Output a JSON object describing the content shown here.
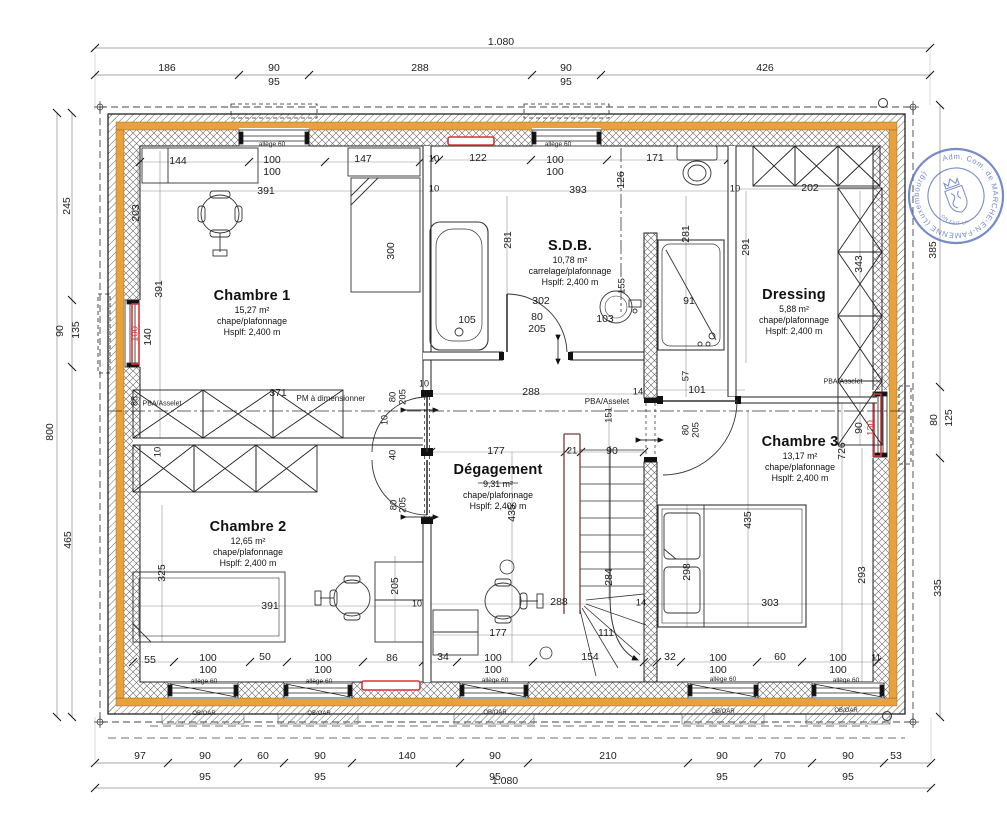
{
  "colors": {
    "wall_orange": "#E8A13C",
    "highlight_red": "#D6353C",
    "stamp_blue": "#5872BE",
    "rail_red": "#7a3b3b",
    "line": "#222222"
  },
  "stamp": {
    "text": "Adm. Com. de MARCHE-EN-FAMENNE (Luxembourg)",
    "inner": "ON FAIT LA"
  },
  "rooms": [
    {
      "name": "Chambre 1",
      "area": "15,27 m²",
      "finish": "chape/plafonnage",
      "height": "Hsplf: 2,400 m",
      "x": 252,
      "y": 289
    },
    {
      "name": "S.D.B.",
      "area": "10,78 m²",
      "finish": "carrelage/plafonnage",
      "height": "Hsplf: 2,400 m",
      "x": 570,
      "y": 239
    },
    {
      "name": "Dressing",
      "area": "5,88 m²",
      "finish": "chape/plafonnage",
      "height": "Hsplf: 2,400 m",
      "x": 794,
      "y": 288
    },
    {
      "name": "Dégagement",
      "area": "9,31 m²",
      "finish": "chape/plafonnage",
      "height": "Hsplf: 2,400 m",
      "x": 498,
      "y": 463
    },
    {
      "name": "Chambre 2",
      "area": "12,65 m²",
      "finish": "chape/plafonnage",
      "height": "Hsplf: 2,400 m",
      "x": 248,
      "y": 520
    },
    {
      "name": "Chambre 3",
      "area": "13,17 m²",
      "finish": "chape/plafonnage",
      "height": "Hsplf: 2,400 m",
      "x": 800,
      "y": 435
    }
  ],
  "labels": [
    {
      "t": "1.080",
      "x": 501,
      "y": 42
    },
    {
      "t": "186",
      "x": 167,
      "y": 68
    },
    {
      "t": "90",
      "x": 274,
      "y": 68
    },
    {
      "t": "95",
      "x": 274,
      "y": 82
    },
    {
      "t": "288",
      "x": 420,
      "y": 68
    },
    {
      "t": "90",
      "x": 566,
      "y": 68
    },
    {
      "t": "95",
      "x": 566,
      "y": 82
    },
    {
      "t": "426",
      "x": 765,
      "y": 68
    },
    {
      "t": "97",
      "x": 140,
      "y": 756
    },
    {
      "t": "90",
      "x": 205,
      "y": 756
    },
    {
      "t": "95",
      "x": 205,
      "y": 777
    },
    {
      "t": "60",
      "x": 263,
      "y": 756
    },
    {
      "t": "90",
      "x": 320,
      "y": 756
    },
    {
      "t": "95",
      "x": 320,
      "y": 777
    },
    {
      "t": "140",
      "x": 407,
      "y": 756
    },
    {
      "t": "90",
      "x": 495,
      "y": 756
    },
    {
      "t": "95",
      "x": 495,
      "y": 777
    },
    {
      "t": "210",
      "x": 608,
      "y": 756
    },
    {
      "t": "90",
      "x": 722,
      "y": 756
    },
    {
      "t": "95",
      "x": 722,
      "y": 777
    },
    {
      "t": "70",
      "x": 780,
      "y": 756
    },
    {
      "t": "90",
      "x": 848,
      "y": 756
    },
    {
      "t": "95",
      "x": 848,
      "y": 777
    },
    {
      "t": "53",
      "x": 896,
      "y": 756
    },
    {
      "t": "1.080",
      "x": 505,
      "y": 781
    },
    {
      "t": "245",
      "x": 67,
      "y": 206,
      "r": -90
    },
    {
      "t": "90",
      "x": 60,
      "y": 331,
      "r": -90
    },
    {
      "t": "135",
      "x": 76,
      "y": 330,
      "r": -90
    },
    {
      "t": "800",
      "x": 50,
      "y": 432,
      "r": -90
    },
    {
      "t": "465",
      "x": 68,
      "y": 540,
      "r": -90
    },
    {
      "t": "385",
      "x": 933,
      "y": 250,
      "r": -90
    },
    {
      "t": "80",
      "x": 934,
      "y": 420,
      "r": -90
    },
    {
      "t": "125",
      "x": 949,
      "y": 418,
      "r": -90
    },
    {
      "t": "335",
      "x": 938,
      "y": 588,
      "r": -90
    },
    {
      "t": "144",
      "x": 178,
      "y": 161
    },
    {
      "t": "100",
      "x": 272,
      "y": 160
    },
    {
      "t": "100",
      "x": 272,
      "y": 172
    },
    {
      "t": "147",
      "x": 363,
      "y": 159
    },
    {
      "t": "10",
      "x": 434,
      "y": 159,
      "s": 9.5
    },
    {
      "t": "122",
      "x": 478,
      "y": 158
    },
    {
      "t": "100",
      "x": 555,
      "y": 160
    },
    {
      "t": "100",
      "x": 555,
      "y": 172
    },
    {
      "t": "171",
      "x": 655,
      "y": 158
    },
    {
      "t": "10",
      "x": 735,
      "y": 189,
      "s": 9.5
    },
    {
      "t": "202",
      "x": 810,
      "y": 188
    },
    {
      "t": "391",
      "x": 266,
      "y": 191
    },
    {
      "t": "10",
      "x": 434,
      "y": 189,
      "s": 9.5
    },
    {
      "t": "393",
      "x": 578,
      "y": 190
    },
    {
      "t": "126",
      "x": 621,
      "y": 180,
      "r": -90
    },
    {
      "t": "203",
      "x": 136,
      "y": 213,
      "r": -90
    },
    {
      "t": "391",
      "x": 159,
      "y": 289,
      "r": -90
    },
    {
      "t": "100",
      "x": 135,
      "y": 334,
      "r": -90,
      "c": "red",
      "s": 9.5
    },
    {
      "t": "140",
      "x": 148,
      "y": 337,
      "r": -90
    },
    {
      "t": "300",
      "x": 391,
      "y": 251,
      "r": -90
    },
    {
      "t": "281",
      "x": 508,
      "y": 240,
      "r": -90
    },
    {
      "t": "281",
      "x": 686,
      "y": 234,
      "r": -90
    },
    {
      "t": "291",
      "x": 746,
      "y": 247,
      "r": -90
    },
    {
      "t": "343",
      "x": 859,
      "y": 264,
      "r": -90
    },
    {
      "t": "155",
      "x": 622,
      "y": 286,
      "r": -90,
      "s": 9.5
    },
    {
      "t": "302",
      "x": 541,
      "y": 301
    },
    {
      "t": "105",
      "x": 467,
      "y": 320
    },
    {
      "t": "80",
      "x": 537,
      "y": 317
    },
    {
      "t": "205",
      "x": 537,
      "y": 329
    },
    {
      "t": "103",
      "x": 605,
      "y": 319
    },
    {
      "t": "91",
      "x": 689,
      "y": 301
    },
    {
      "t": "88",
      "x": 135,
      "y": 401,
      "r": -90,
      "s": 9
    },
    {
      "t": "PBA/Asselet",
      "x": 162,
      "y": 404,
      "s": 7
    },
    {
      "t": "371",
      "x": 278,
      "y": 393
    },
    {
      "t": "PM à dimensionner",
      "x": 331,
      "y": 399,
      "s": 8
    },
    {
      "t": "10",
      "x": 158,
      "y": 452,
      "r": -90,
      "s": 9.5
    },
    {
      "t": "80",
      "x": 393,
      "y": 397,
      "r": -90,
      "s": 9.5
    },
    {
      "t": "205",
      "x": 403,
      "y": 397,
      "r": -90,
      "s": 9.5
    },
    {
      "t": "10",
      "x": 424,
      "y": 384,
      "s": 9
    },
    {
      "t": "10",
      "x": 385,
      "y": 420,
      "r": -90,
      "s": 9
    },
    {
      "t": "40",
      "x": 393,
      "y": 455,
      "r": -90,
      "s": 9.5
    },
    {
      "t": "288",
      "x": 531,
      "y": 392
    },
    {
      "t": "PBA/Asselet",
      "x": 607,
      "y": 402,
      "s": 8
    },
    {
      "t": "14",
      "x": 638,
      "y": 392,
      "s": 9.5
    },
    {
      "t": "151",
      "x": 609,
      "y": 415,
      "r": -90,
      "s": 9.5
    },
    {
      "t": "57",
      "x": 686,
      "y": 376,
      "r": -90,
      "s": 9.5
    },
    {
      "t": "101",
      "x": 697,
      "y": 390
    },
    {
      "t": "PBA/Asselet",
      "x": 843,
      "y": 382,
      "s": 7
    },
    {
      "t": "80",
      "x": 686,
      "y": 430,
      "r": -90,
      "s": 9.5
    },
    {
      "t": "205",
      "x": 696,
      "y": 430,
      "r": -90,
      "s": 9.5
    },
    {
      "t": "90",
      "x": 859,
      "y": 428,
      "r": -90
    },
    {
      "t": "130",
      "x": 871,
      "y": 428,
      "r": -90,
      "c": "red",
      "s": 9.5
    },
    {
      "t": "726",
      "x": 842,
      "y": 451,
      "r": -90
    },
    {
      "t": "177",
      "x": 496,
      "y": 451
    },
    {
      "t": "21",
      "x": 572,
      "y": 451,
      "s": 9.5
    },
    {
      "t": "90",
      "x": 612,
      "y": 451
    },
    {
      "t": "435",
      "x": 512,
      "y": 513,
      "r": -90
    },
    {
      "t": "435",
      "x": 748,
      "y": 520,
      "r": -90
    },
    {
      "t": "80",
      "x": 394,
      "y": 505,
      "r": -90,
      "s": 9.5
    },
    {
      "t": "205",
      "x": 403,
      "y": 505,
      "r": -90,
      "s": 9.5
    },
    {
      "t": "205",
      "x": 395,
      "y": 586,
      "r": -90
    },
    {
      "t": "325",
      "x": 162,
      "y": 573,
      "r": -90
    },
    {
      "t": "391",
      "x": 270,
      "y": 606
    },
    {
      "t": "288",
      "x": 559,
      "y": 602
    },
    {
      "t": "14",
      "x": 641,
      "y": 603,
      "s": 9.5
    },
    {
      "t": "303",
      "x": 770,
      "y": 603
    },
    {
      "t": "284",
      "x": 609,
      "y": 577,
      "r": -90
    },
    {
      "t": "298",
      "x": 687,
      "y": 572,
      "r": -90
    },
    {
      "t": "293",
      "x": 862,
      "y": 575,
      "r": -90
    },
    {
      "t": "10",
      "x": 417,
      "y": 604,
      "s": 9
    },
    {
      "t": "177",
      "x": 498,
      "y": 633
    },
    {
      "t": "111",
      "x": 606,
      "y": 633
    },
    {
      "t": "154",
      "x": 590,
      "y": 657
    },
    {
      "t": "34",
      "x": 443,
      "y": 657
    },
    {
      "t": "55",
      "x": 150,
      "y": 660
    },
    {
      "t": "100",
      "x": 208,
      "y": 658
    },
    {
      "t": "100",
      "x": 208,
      "y": 670
    },
    {
      "t": "50",
      "x": 265,
      "y": 657
    },
    {
      "t": "100",
      "x": 323,
      "y": 658
    },
    {
      "t": "100",
      "x": 323,
      "y": 670
    },
    {
      "t": "86",
      "x": 392,
      "y": 658
    },
    {
      "t": "100",
      "x": 493,
      "y": 658
    },
    {
      "t": "100",
      "x": 493,
      "y": 670
    },
    {
      "t": "32",
      "x": 670,
      "y": 657
    },
    {
      "t": "100",
      "x": 718,
      "y": 658
    },
    {
      "t": "100",
      "x": 718,
      "y": 670
    },
    {
      "t": "60",
      "x": 780,
      "y": 657
    },
    {
      "t": "100",
      "x": 838,
      "y": 658
    },
    {
      "t": "100",
      "x": 838,
      "y": 670
    },
    {
      "t": "11",
      "x": 876,
      "y": 658,
      "s": 9.5
    },
    {
      "t": "allège 60",
      "x": 272,
      "y": 145,
      "s": 6.5
    },
    {
      "t": "allège 60",
      "x": 558,
      "y": 145,
      "s": 6.5
    },
    {
      "t": "allège 60",
      "x": 204,
      "y": 682,
      "s": 6.5
    },
    {
      "t": "allège 60",
      "x": 319,
      "y": 682,
      "s": 6.5
    },
    {
      "t": "allège 60",
      "x": 495,
      "y": 681,
      "s": 6.5
    },
    {
      "t": "allège 60",
      "x": 723,
      "y": 680,
      "s": 6.5
    },
    {
      "t": "allège 60",
      "x": 846,
      "y": 681,
      "s": 6.5
    },
    {
      "t": "OB/OAR",
      "x": 204,
      "y": 714,
      "s": 6
    },
    {
      "t": "OB/OAR",
      "x": 319,
      "y": 714,
      "s": 6
    },
    {
      "t": "OB/OAR",
      "x": 495,
      "y": 713,
      "s": 6
    },
    {
      "t": "OB/OAR",
      "x": 723,
      "y": 712,
      "s": 6
    },
    {
      "t": "OB/OAR",
      "x": 846,
      "y": 711,
      "s": 6
    }
  ]
}
